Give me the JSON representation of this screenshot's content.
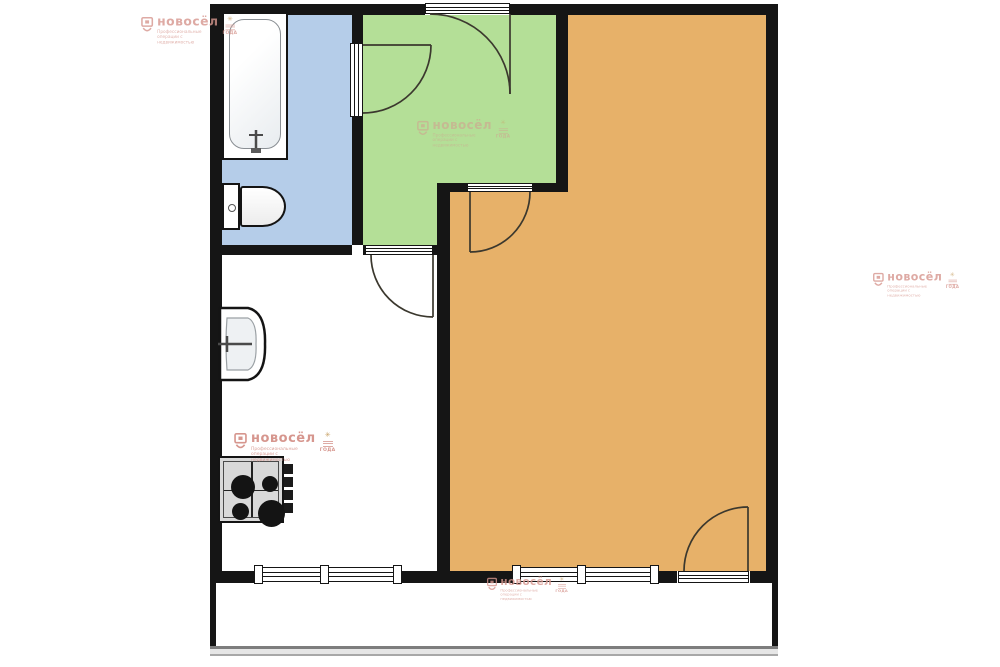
{
  "colors": {
    "wall": "#151515",
    "room-bathroom": "#b5cde9",
    "room-hallway": "#b4df97",
    "room-living": "#e7b169",
    "room-kitchen": "#ffffff",
    "room-balcony": "#ffffff",
    "door-stroke": "#3b372e",
    "fixture-stroke": "#141414",
    "watermark-pink": "#d6968e",
    "balcony-rail": "#7d7d7d"
  },
  "watermark": {
    "brand": "новосёл",
    "tagline": "Профессиональные операции с недвижимостью",
    "badge": "ГОДА"
  }
}
